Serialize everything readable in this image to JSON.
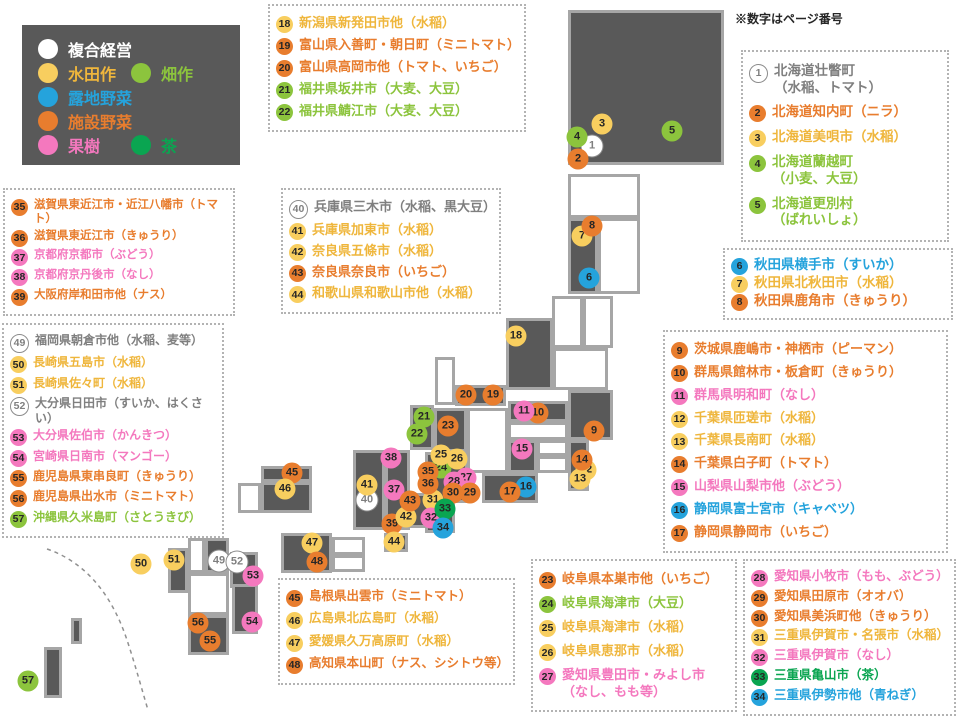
{
  "note_label": "※数字はページ番号",
  "palette": {
    "white": {
      "fill": "#ffffff",
      "text": "#7f7f7f",
      "border": "#8c8c8c"
    },
    "yellow": {
      "fill": "#f8ce5f",
      "text": "#efb63c"
    },
    "blue": {
      "fill": "#25a3dc",
      "text": "#25a3dc"
    },
    "orange": {
      "fill": "#e87d2e",
      "text": "#e87d2e"
    },
    "pink": {
      "fill": "#f478be",
      "text": "#f478be"
    },
    "green": {
      "fill": "#8cc43d",
      "text": "#8cc43d"
    },
    "teagreen": {
      "fill": "#0aa551",
      "text": "#0aa551"
    },
    "tile_fill": "#595959",
    "tile_border": "#a6a6a6",
    "marker_number": "#262626"
  },
  "legend": {
    "rows": [
      [
        {
          "label": "複合経営",
          "color": "white",
          "text_color": "#ffffff"
        }
      ],
      [
        {
          "label": "水田作",
          "color": "yellow"
        },
        {
          "label": "畑作",
          "color": "green"
        }
      ],
      [
        {
          "label": "露地野菜",
          "color": "blue"
        }
      ],
      [
        {
          "label": "施設野菜",
          "color": "orange"
        }
      ],
      [
        {
          "label": "果樹",
          "color": "pink"
        },
        {
          "label": "茶",
          "color": "teagreen"
        }
      ]
    ]
  },
  "boxes": [
    {
      "id": "hokuriku",
      "x": 268,
      "y": 4,
      "w": 258,
      "h": 128,
      "items": [
        {
          "n": "18",
          "c": "yellow",
          "lines": [
            "新潟県新発田市他（水稲）"
          ]
        },
        {
          "n": "19",
          "c": "orange",
          "lines": [
            "富山県入善町・朝日町（ミニトマト）"
          ]
        },
        {
          "n": "20",
          "c": "orange",
          "lines": [
            "富山県高岡市他（トマト、いちご）"
          ]
        },
        {
          "n": "21",
          "c": "green",
          "lines": [
            "福井県坂井市（大麦、大豆）"
          ]
        },
        {
          "n": "22",
          "c": "green",
          "lines": [
            "福井県鯖江市（大麦、大豆）"
          ]
        }
      ]
    },
    {
      "id": "hokkaido",
      "x": 741,
      "y": 50,
      "w": 208,
      "h": 192,
      "items": [
        {
          "n": "1",
          "c": "white",
          "lines": [
            "北海道壮瞥町",
            "（水稲、トマト）"
          ]
        },
        {
          "n": "2",
          "c": "orange",
          "lines": [
            "北海道知内町（ニラ）"
          ]
        },
        {
          "n": "3",
          "c": "yellow",
          "lines": [
            "北海道美唄市（水稲）"
          ]
        },
        {
          "n": "4",
          "c": "green",
          "lines": [
            "北海道蘭越町",
            "（小麦、大豆）"
          ]
        },
        {
          "n": "5",
          "c": "green",
          "lines": [
            "北海道更別村",
            "（ばれいしょ）"
          ]
        }
      ]
    },
    {
      "id": "akita",
      "x": 723,
      "y": 248,
      "w": 230,
      "h": 72,
      "items": [
        {
          "n": "6",
          "c": "blue",
          "lines": [
            "秋田県横手市（すいか）"
          ]
        },
        {
          "n": "7",
          "c": "yellow",
          "lines": [
            "秋田県北秋田市（水稲）"
          ]
        },
        {
          "n": "8",
          "c": "orange",
          "lines": [
            "秋田県鹿角市（きゅうり）"
          ]
        }
      ]
    },
    {
      "id": "kanto",
      "x": 663,
      "y": 330,
      "w": 285,
      "h": 223,
      "items": [
        {
          "n": "9",
          "c": "orange",
          "lines": [
            "茨城県鹿嶋市・神栖市（ピーマン）"
          ]
        },
        {
          "n": "10",
          "c": "orange",
          "lines": [
            "群馬県館林市・板倉町（きゅうり）"
          ]
        },
        {
          "n": "11",
          "c": "pink",
          "lines": [
            "群馬県明和町（なし）"
          ]
        },
        {
          "n": "12",
          "c": "yellow",
          "lines": [
            "千葉県匝瑳市（水稲）"
          ]
        },
        {
          "n": "13",
          "c": "yellow",
          "lines": [
            "千葉県長南町（水稲）"
          ]
        },
        {
          "n": "14",
          "c": "orange",
          "lines": [
            "千葉県白子町（トマト）"
          ]
        },
        {
          "n": "15",
          "c": "pink",
          "lines": [
            "山梨県山梨市他（ぶどう）"
          ]
        },
        {
          "n": "16",
          "c": "blue",
          "lines": [
            "静岡県富士宮市（キャベツ）"
          ]
        },
        {
          "n": "17",
          "c": "orange",
          "lines": [
            "静岡県静岡市（いちご）"
          ]
        }
      ]
    },
    {
      "id": "shiga",
      "x": 3,
      "y": 188,
      "w": 232,
      "h": 128,
      "items": [
        {
          "n": "35",
          "c": "orange",
          "lines": [
            "滋賀県東近江市・近江八幡市（トマト）"
          ]
        },
        {
          "n": "36",
          "c": "orange",
          "lines": [
            "滋賀県東近江市（きゅうり）"
          ]
        },
        {
          "n": "37",
          "c": "pink",
          "lines": [
            "京都府京都市（ぶどう）"
          ]
        },
        {
          "n": "38",
          "c": "pink",
          "lines": [
            "京都府京丹後市（なし）"
          ]
        },
        {
          "n": "39",
          "c": "orange",
          "lines": [
            "大阪府岸和田市他（ナス）"
          ]
        }
      ]
    },
    {
      "id": "hyogo",
      "x": 281,
      "y": 188,
      "w": 220,
      "h": 126,
      "items": [
        {
          "n": "40",
          "c": "white",
          "lines": [
            "兵庫県三木市（水稲、黒大豆）"
          ]
        },
        {
          "n": "41",
          "c": "yellow",
          "lines": [
            "兵庫県加東市（水稲）"
          ]
        },
        {
          "n": "42",
          "c": "yellow",
          "lines": [
            "奈良県五條市（水稲）"
          ]
        },
        {
          "n": "43",
          "c": "orange",
          "lines": [
            "奈良県奈良市（いちご）"
          ]
        },
        {
          "n": "44",
          "c": "yellow",
          "lines": [
            "和歌山県和歌山市他（水稲）"
          ]
        }
      ]
    },
    {
      "id": "kyushu",
      "x": 2,
      "y": 323,
      "w": 222,
      "h": 215,
      "items": [
        {
          "n": "49",
          "c": "white",
          "lines": [
            "福岡県朝倉市他（水稲、麦等）"
          ]
        },
        {
          "n": "50",
          "c": "yellow",
          "lines": [
            "長崎県五島市（水稲）"
          ]
        },
        {
          "n": "51",
          "c": "yellow",
          "lines": [
            "長崎県佐々町（水稲）"
          ]
        },
        {
          "n": "52",
          "c": "white",
          "lines": [
            "大分県日田市（すいか、はくさい）"
          ]
        },
        {
          "n": "53",
          "c": "pink",
          "lines": [
            "大分県佐伯市（かんきつ）"
          ]
        },
        {
          "n": "54",
          "c": "pink",
          "lines": [
            "宮崎県日南市（マンゴー）"
          ]
        },
        {
          "n": "55",
          "c": "orange",
          "lines": [
            "鹿児島県東串良町（きゅうり）"
          ]
        },
        {
          "n": "56",
          "c": "orange",
          "lines": [
            "鹿児島県出水市（ミニトマト）"
          ]
        },
        {
          "n": "57",
          "c": "green",
          "lines": [
            "沖縄県久米島町（さとうきび）"
          ]
        }
      ]
    },
    {
      "id": "chugoku",
      "x": 278,
      "y": 578,
      "w": 237,
      "h": 107,
      "items": [
        {
          "n": "45",
          "c": "orange",
          "lines": [
            "島根県出雲市（ミニトマト）"
          ]
        },
        {
          "n": "46",
          "c": "yellow",
          "lines": [
            "広島県北広島町（水稲）"
          ]
        },
        {
          "n": "47",
          "c": "yellow",
          "lines": [
            "愛媛県久万高原町（水稲）"
          ]
        },
        {
          "n": "48",
          "c": "orange",
          "lines": [
            "高知県本山町（ナス、シシトウ等）"
          ]
        }
      ]
    },
    {
      "id": "gifu",
      "x": 531,
      "y": 559,
      "w": 206,
      "h": 153,
      "items": [
        {
          "n": "23",
          "c": "orange",
          "lines": [
            "岐阜県本巣市他（いちご）"
          ]
        },
        {
          "n": "24",
          "c": "green",
          "lines": [
            "岐阜県海津市（大豆）"
          ]
        },
        {
          "n": "25",
          "c": "yellow",
          "lines": [
            "岐阜県海津市（水稲）"
          ]
        },
        {
          "n": "26",
          "c": "yellow",
          "lines": [
            "岐阜県恵那市（水稲）"
          ]
        },
        {
          "n": "27",
          "c": "pink",
          "lines": [
            "愛知県豊田市・みよし市",
            "（なし、もも等）"
          ]
        }
      ]
    },
    {
      "id": "aichi",
      "x": 743,
      "y": 559,
      "w": 213,
      "h": 157,
      "items": [
        {
          "n": "28",
          "c": "pink",
          "lines": [
            "愛知県小牧市（もも、ぶどう）"
          ]
        },
        {
          "n": "29",
          "c": "orange",
          "lines": [
            "愛知県田原市（オオバ）"
          ]
        },
        {
          "n": "30",
          "c": "orange",
          "lines": [
            "愛知県美浜町他（きゅうり）"
          ]
        },
        {
          "n": "31",
          "c": "yellow",
          "lines": [
            "三重県伊賀市・名張市（水稲）"
          ]
        },
        {
          "n": "32",
          "c": "pink",
          "lines": [
            "三重県伊賀市（なし）"
          ]
        },
        {
          "n": "33",
          "c": "teagreen",
          "lines": [
            "三重県亀山市（茶）"
          ]
        },
        {
          "n": "34",
          "c": "blue",
          "lines": [
            "三重県伊勢市他（青ねぎ）"
          ]
        }
      ]
    }
  ],
  "map": {
    "dark_tiles": [
      {
        "x": 568,
        "y": 10,
        "w": 156,
        "h": 155
      },
      {
        "x": 568,
        "y": 218,
        "w": 30,
        "h": 76
      },
      {
        "x": 506,
        "y": 318,
        "w": 47,
        "h": 72
      },
      {
        "x": 455,
        "y": 385,
        "w": 51,
        "h": 21
      },
      {
        "x": 508,
        "y": 401,
        "w": 60,
        "h": 21
      },
      {
        "x": 568,
        "y": 390,
        "w": 45,
        "h": 50
      },
      {
        "x": 568,
        "y": 440,
        "w": 21,
        "h": 51
      },
      {
        "x": 508,
        "y": 440,
        "w": 29,
        "h": 33
      },
      {
        "x": 482,
        "y": 473,
        "w": 56,
        "h": 30
      },
      {
        "x": 410,
        "y": 405,
        "w": 24,
        "h": 45
      },
      {
        "x": 434,
        "y": 408,
        "w": 33,
        "h": 44
      },
      {
        "x": 425,
        "y": 452,
        "w": 43,
        "h": 51
      },
      {
        "x": 425,
        "y": 503,
        "w": 30,
        "h": 30
      },
      {
        "x": 353,
        "y": 450,
        "w": 32,
        "h": 80
      },
      {
        "x": 385,
        "y": 450,
        "w": 25,
        "h": 80
      },
      {
        "x": 404,
        "y": 493,
        "w": 28,
        "h": 35
      },
      {
        "x": 384,
        "y": 533,
        "w": 24,
        "h": 19
      },
      {
        "x": 261,
        "y": 466,
        "w": 51,
        "h": 16
      },
      {
        "x": 261,
        "y": 482,
        "w": 51,
        "h": 31
      },
      {
        "x": 281,
        "y": 533,
        "w": 51,
        "h": 40
      },
      {
        "x": 205,
        "y": 538,
        "w": 24,
        "h": 35
      },
      {
        "x": 168,
        "y": 548,
        "w": 20,
        "h": 45
      },
      {
        "x": 230,
        "y": 552,
        "w": 28,
        "h": 36
      },
      {
        "x": 232,
        "y": 584,
        "w": 26,
        "h": 50
      },
      {
        "x": 188,
        "y": 615,
        "w": 41,
        "h": 40
      },
      {
        "x": 71,
        "y": 618,
        "w": 11,
        "h": 26
      },
      {
        "x": 44,
        "y": 647,
        "w": 18,
        "h": 51
      }
    ],
    "white_tiles": [
      {
        "x": 568,
        "y": 174,
        "w": 72,
        "h": 44
      },
      {
        "x": 598,
        "y": 218,
        "w": 42,
        "h": 76
      },
      {
        "x": 552,
        "y": 296,
        "w": 31,
        "h": 52
      },
      {
        "x": 583,
        "y": 296,
        "w": 30,
        "h": 52
      },
      {
        "x": 553,
        "y": 348,
        "w": 55,
        "h": 42
      },
      {
        "x": 435,
        "y": 357,
        "w": 20,
        "h": 48
      },
      {
        "x": 467,
        "y": 408,
        "w": 41,
        "h": 65
      },
      {
        "x": 508,
        "y": 422,
        "w": 60,
        "h": 18
      },
      {
        "x": 537,
        "y": 440,
        "w": 31,
        "h": 16
      },
      {
        "x": 537,
        "y": 456,
        "w": 31,
        "h": 17
      },
      {
        "x": 332,
        "y": 537,
        "w": 33,
        "h": 18
      },
      {
        "x": 332,
        "y": 555,
        "w": 33,
        "h": 17
      },
      {
        "x": 238,
        "y": 483,
        "w": 23,
        "h": 30
      },
      {
        "x": 188,
        "y": 538,
        "w": 17,
        "h": 35
      },
      {
        "x": 188,
        "y": 573,
        "w": 41,
        "h": 42
      }
    ],
    "divider_path": "M47,549 C88,563 113,598 127,640 C135,664 142,690 148,710"
  },
  "markers": [
    {
      "n": "1",
      "c": "white",
      "x": 592,
      "y": 146
    },
    {
      "n": "2",
      "c": "orange",
      "x": 578,
      "y": 159
    },
    {
      "n": "3",
      "c": "yellow",
      "x": 602,
      "y": 124
    },
    {
      "n": "4",
      "c": "green",
      "x": 577,
      "y": 137
    },
    {
      "n": "5",
      "c": "green",
      "x": 672,
      "y": 131
    },
    {
      "n": "6",
      "c": "blue",
      "x": 589,
      "y": 278
    },
    {
      "n": "7",
      "c": "yellow",
      "x": 582,
      "y": 236
    },
    {
      "n": "8",
      "c": "orange",
      "x": 592,
      "y": 226
    },
    {
      "n": "9",
      "c": "orange",
      "x": 594,
      "y": 431
    },
    {
      "n": "10",
      "c": "orange",
      "x": 538,
      "y": 413
    },
    {
      "n": "11",
      "c": "pink",
      "x": 524,
      "y": 411
    },
    {
      "n": "12",
      "c": "yellow",
      "x": 586,
      "y": 470
    },
    {
      "n": "13",
      "c": "yellow",
      "x": 580,
      "y": 479
    },
    {
      "n": "14",
      "c": "orange",
      "x": 582,
      "y": 460
    },
    {
      "n": "15",
      "c": "pink",
      "x": 522,
      "y": 449
    },
    {
      "n": "16",
      "c": "blue",
      "x": 526,
      "y": 487
    },
    {
      "n": "17",
      "c": "orange",
      "x": 510,
      "y": 492
    },
    {
      "n": "18",
      "c": "yellow",
      "x": 516,
      "y": 336
    },
    {
      "n": "19",
      "c": "orange",
      "x": 493,
      "y": 395
    },
    {
      "n": "20",
      "c": "orange",
      "x": 466,
      "y": 395
    },
    {
      "n": "21",
      "c": "green",
      "x": 424,
      "y": 417
    },
    {
      "n": "22",
      "c": "green",
      "x": 417,
      "y": 434
    },
    {
      "n": "23",
      "c": "orange",
      "x": 448,
      "y": 426
    },
    {
      "n": "24",
      "c": "green",
      "x": 441,
      "y": 468
    },
    {
      "n": "25",
      "c": "yellow",
      "x": 441,
      "y": 455
    },
    {
      "n": "26",
      "c": "yellow",
      "x": 457,
      "y": 459
    },
    {
      "n": "27",
      "c": "pink",
      "x": 466,
      "y": 478
    },
    {
      "n": "28",
      "c": "pink",
      "x": 454,
      "y": 482
    },
    {
      "n": "29",
      "c": "orange",
      "x": 470,
      "y": 493
    },
    {
      "n": "30",
      "c": "orange",
      "x": 453,
      "y": 493
    },
    {
      "n": "31",
      "c": "yellow",
      "x": 433,
      "y": 500
    },
    {
      "n": "32",
      "c": "pink",
      "x": 431,
      "y": 518
    },
    {
      "n": "33",
      "c": "teagreen",
      "x": 445,
      "y": 509
    },
    {
      "n": "34",
      "c": "blue",
      "x": 443,
      "y": 528
    },
    {
      "n": "35",
      "c": "orange",
      "x": 428,
      "y": 472
    },
    {
      "n": "36",
      "c": "orange",
      "x": 428,
      "y": 484
    },
    {
      "n": "37",
      "c": "pink",
      "x": 394,
      "y": 490
    },
    {
      "n": "38",
      "c": "pink",
      "x": 391,
      "y": 458
    },
    {
      "n": "39",
      "c": "orange",
      "x": 392,
      "y": 524
    },
    {
      "n": "40",
      "c": "white",
      "x": 367,
      "y": 500
    },
    {
      "n": "41",
      "c": "yellow",
      "x": 367,
      "y": 485
    },
    {
      "n": "42",
      "c": "yellow",
      "x": 406,
      "y": 517
    },
    {
      "n": "43",
      "c": "orange",
      "x": 410,
      "y": 501
    },
    {
      "n": "44",
      "c": "yellow",
      "x": 394,
      "y": 542
    },
    {
      "n": "45",
      "c": "orange",
      "x": 292,
      "y": 473
    },
    {
      "n": "46",
      "c": "yellow",
      "x": 285,
      "y": 489
    },
    {
      "n": "47",
      "c": "yellow",
      "x": 312,
      "y": 543
    },
    {
      "n": "48",
      "c": "orange",
      "x": 317,
      "y": 562
    },
    {
      "n": "49",
      "c": "white",
      "x": 219,
      "y": 561
    },
    {
      "n": "50",
      "c": "yellow",
      "x": 141,
      "y": 564
    },
    {
      "n": "51",
      "c": "yellow",
      "x": 174,
      "y": 560
    },
    {
      "n": "52",
      "c": "white",
      "x": 237,
      "y": 562
    },
    {
      "n": "53",
      "c": "pink",
      "x": 253,
      "y": 576
    },
    {
      "n": "54",
      "c": "pink",
      "x": 252,
      "y": 622
    },
    {
      "n": "55",
      "c": "orange",
      "x": 210,
      "y": 641
    },
    {
      "n": "56",
      "c": "orange",
      "x": 198,
      "y": 623
    },
    {
      "n": "57",
      "c": "green",
      "x": 28,
      "y": 681
    }
  ]
}
